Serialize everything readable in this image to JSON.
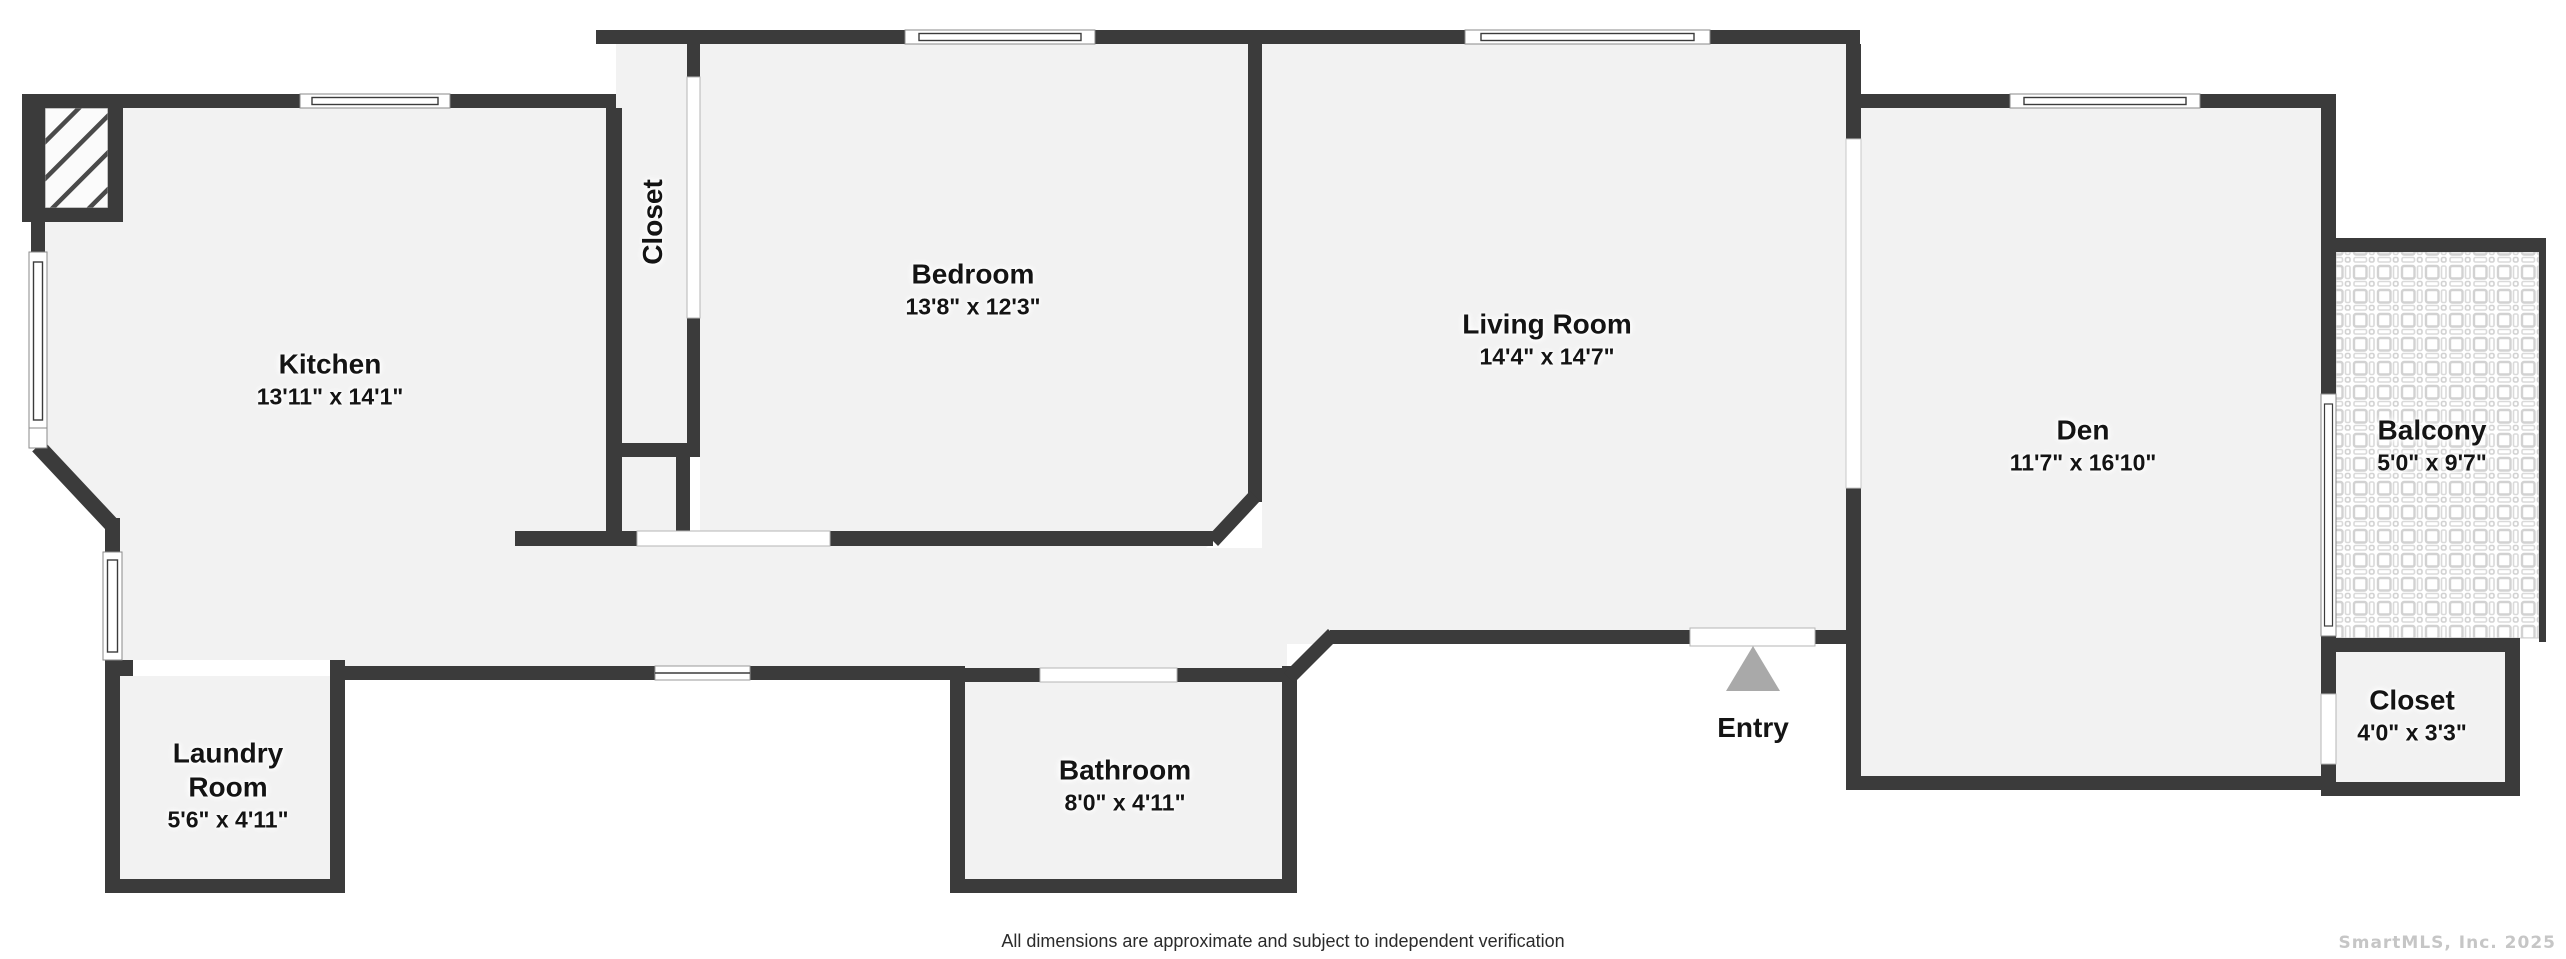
{
  "title": "Apartment floor plan",
  "disclaimer": "All dimensions are approximate and subject to independent verification",
  "watermark": "SmartMLS, Inc.  2025",
  "colors": {
    "wall": "#3b3b3b",
    "floor": "#f2f2f2",
    "entry_triangle": "#a9a9a9",
    "tile_line": "#d2d2d2",
    "hatch_line": "#4a4a4a"
  },
  "rooms": {
    "kitchen": {
      "name": "Kitchen",
      "dims": "13'11\" x 14'1\""
    },
    "closet_hall": {
      "name": "Closet"
    },
    "bedroom": {
      "name": "Bedroom",
      "dims": "13'8\" x 12'3\""
    },
    "living_room": {
      "name": "Living Room",
      "dims": "14'4\" x 14'7\""
    },
    "den": {
      "name": "Den",
      "dims": "11'7\" x 16'10\""
    },
    "balcony": {
      "name": "Balcony",
      "dims": "5'0\" x 9'7\""
    },
    "closet_br": {
      "name": "Closet",
      "dims": "4'0\" x 3'3\""
    },
    "laundry": {
      "name_line1": "Laundry",
      "name_line2": "Room",
      "dims": "5'6\" x 4'11\""
    },
    "bathroom": {
      "name": "Bathroom",
      "dims": "8'0\" x 4'11\""
    },
    "entry": {
      "name": "Entry"
    }
  }
}
